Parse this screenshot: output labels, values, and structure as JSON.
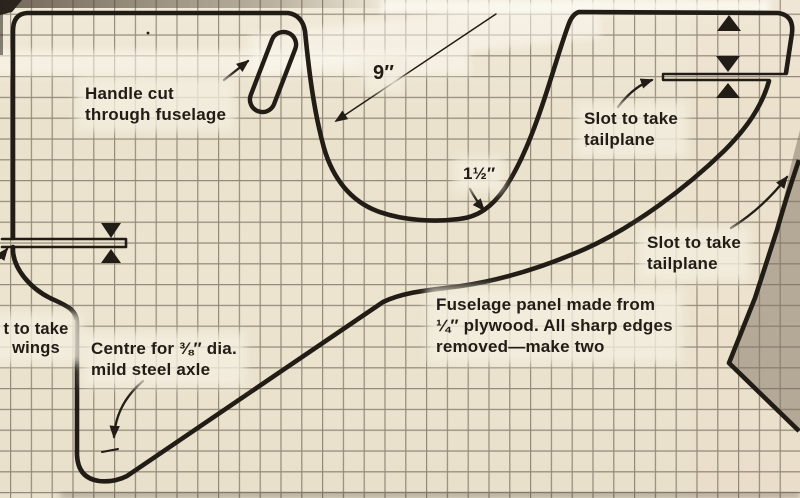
{
  "annotations": {
    "handle": {
      "text": "Handle cut\nthrough fuselage"
    },
    "radius": {
      "text": "9″"
    },
    "saddle_depth": {
      "text": "1½″"
    },
    "tailplane_slot_upper": {
      "text": "Slot to take\ntailplane"
    },
    "tailplane_slot_lower": {
      "text": "Slot to take\ntailplane"
    },
    "wing_slot": {
      "text": "t to take\nwings"
    },
    "axle": {
      "text": "Centre for ⅜″ dia.\nmild steel axle"
    },
    "panel_note": {
      "text": "Fuselage panel made from\n¼″ plywood. All sharp edges\nremoved—make two"
    }
  },
  "colors": {
    "paper": "#ece4d0",
    "ink": "#211c15",
    "grid_line": "rgba(60,50,38,0.5)",
    "shaded_panel": "rgba(125,114,97,0.5)",
    "label_patch": "rgba(243,237,223,0.8)"
  }
}
